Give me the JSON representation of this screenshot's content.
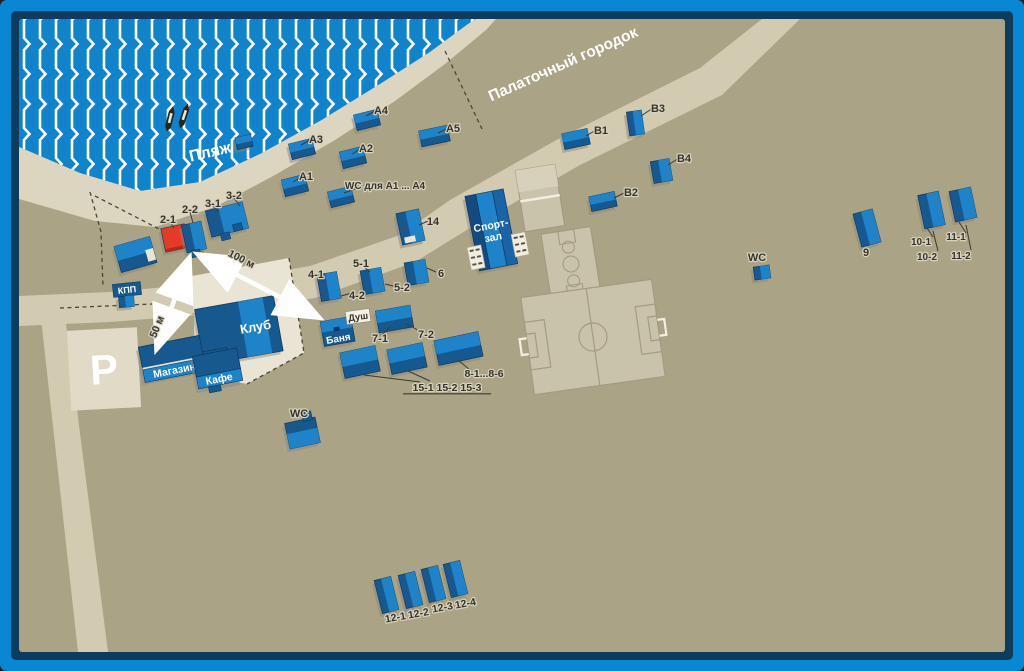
{
  "map_data": {
    "colors": {
      "frame_outer": "#0a87d3",
      "frame_inner": "#0e3c5f",
      "ground": "#aba385",
      "water": "#0f83cb",
      "wave": "#ffffff",
      "sand": "#dcd5c0",
      "road": "#d2cbb2",
      "plaza": "#e9e4d3",
      "parking": "#e0dac7",
      "field": "#c9c3ac",
      "field_line": "#a09880",
      "bldg_dark": "#17598f",
      "bldg_bright": "#1f83c9",
      "bldg_edge": "#0b3b64",
      "red_bright": "#e63a28",
      "red_dark": "#b52718",
      "shadow": "#8e8671",
      "white_detail": "#e9e4d4",
      "label": "#35332c"
    },
    "area_labels": {
      "beach": "Пляж",
      "tent_city": "Палаточный городок",
      "parking": "P",
      "sport_hall_1": "Спорт-",
      "sport_hall_2": "зал",
      "club": "Клуб",
      "shop": "Магазин",
      "cafe": "Кафе",
      "banya": "Баня",
      "dush": "Душ",
      "kpp": "КПП"
    },
    "arrows": [
      {
        "id": "arrow-50m",
        "text": "50 м",
        "x1": 157,
        "y1": 348,
        "x2": 189,
        "y2": 259,
        "tx": 160,
        "ty": 328,
        "rot": -68
      },
      {
        "id": "arrow-100m",
        "text": "100 м",
        "x1": 199,
        "y1": 255,
        "x2": 318,
        "y2": 317,
        "tx": 240,
        "ty": 262,
        "rot": 27
      }
    ],
    "buildings": [
      {
        "id": "A1",
        "x": 283,
        "y": 177,
        "w": 24,
        "h": 17,
        "a": -14,
        "s": "h"
      },
      {
        "id": "A2",
        "x": 341,
        "y": 149,
        "w": 24,
        "h": 17,
        "a": -14,
        "s": "h"
      },
      {
        "id": "A3",
        "x": 290,
        "y": 141,
        "w": 24,
        "h": 16,
        "a": -14,
        "s": "h"
      },
      {
        "id": "A4",
        "x": 355,
        "y": 112,
        "w": 24,
        "h": 16,
        "a": -14,
        "s": "h"
      },
      {
        "id": "A5",
        "x": 420,
        "y": 128,
        "w": 29,
        "h": 16,
        "a": -12,
        "s": "h"
      },
      {
        "id": "wc-a",
        "x": 329,
        "y": 189,
        "w": 24,
        "h": 16,
        "a": -14,
        "s": "h"
      },
      {
        "id": "B1",
        "x": 563,
        "y": 131,
        "w": 26,
        "h": 16,
        "a": -12,
        "s": "h"
      },
      {
        "id": "B2",
        "x": 590,
        "y": 194,
        "w": 26,
        "h": 15,
        "a": -12,
        "s": "h"
      },
      {
        "id": "B3",
        "x": 628,
        "y": 111,
        "w": 15,
        "h": 24,
        "a": -8,
        "s": "v"
      },
      {
        "id": "B4",
        "x": 652,
        "y": 160,
        "w": 19,
        "h": 22,
        "a": -10,
        "s": "v"
      },
      {
        "id": "9",
        "x": 857,
        "y": 211,
        "w": 20,
        "h": 34,
        "a": -15,
        "s": "v"
      },
      {
        "id": "10",
        "x": 921,
        "y": 193,
        "w": 21,
        "h": 34,
        "a": -12,
        "s": "v"
      },
      {
        "id": "11",
        "x": 952,
        "y": 189,
        "w": 22,
        "h": 31,
        "a": -12,
        "s": "v"
      },
      {
        "id": "14",
        "x": 399,
        "y": 211,
        "w": 23,
        "h": 32,
        "a": -12,
        "s": "v",
        "wx": [
          [
            402,
            236,
            11,
            6
          ]
        ]
      },
      {
        "id": "12-1",
        "x": 378,
        "y": 578,
        "w": 17,
        "h": 34,
        "a": -14,
        "s": "v"
      },
      {
        "id": "12-2",
        "x": 402,
        "y": 573,
        "w": 17,
        "h": 34,
        "a": -14,
        "s": "v"
      },
      {
        "id": "12-3",
        "x": 425,
        "y": 567,
        "w": 17,
        "h": 34,
        "a": -14,
        "s": "v"
      },
      {
        "id": "12-4",
        "x": 447,
        "y": 562,
        "w": 17,
        "h": 34,
        "a": -14,
        "s": "v"
      },
      {
        "id": "4",
        "x": 319,
        "y": 273,
        "w": 20,
        "h": 27,
        "a": -10,
        "s": "v"
      },
      {
        "id": "5",
        "x": 362,
        "y": 269,
        "w": 21,
        "h": 24,
        "a": -10,
        "s": "v"
      },
      {
        "id": "6",
        "x": 406,
        "y": 261,
        "w": 21,
        "h": 23,
        "a": -10,
        "s": "v"
      },
      {
        "id": "2-1",
        "x": 163,
        "y": 226,
        "w": 24,
        "h": 24,
        "a": -12,
        "s": "red"
      },
      {
        "id": "2-2",
        "x": 184,
        "y": 223,
        "w": 20,
        "h": 28,
        "a": -12,
        "s": "v",
        "ax": [
          [
            188,
            250,
            9,
            7
          ]
        ]
      },
      {
        "id": "3",
        "x": 208,
        "y": 206,
        "w": 38,
        "h": 27,
        "a": -14,
        "s": "v3",
        "ax": [
          [
            217,
            232,
            9,
            7
          ],
          [
            231,
            226,
            9,
            7
          ]
        ]
      },
      {
        "id": "gate",
        "x": 117,
        "y": 241,
        "w": 37,
        "h": 27,
        "a": -16,
        "s": "h",
        "wx": [
          [
            146,
            253,
            8,
            12
          ]
        ]
      },
      {
        "id": "7",
        "x": 377,
        "y": 308,
        "w": 35,
        "h": 22,
        "a": -10,
        "s": "h"
      },
      {
        "id": "15-1",
        "x": 342,
        "y": 349,
        "w": 36,
        "h": 26,
        "a": -12,
        "s": "h"
      },
      {
        "id": "15-2",
        "x": 389,
        "y": 346,
        "w": 36,
        "h": 25,
        "a": -12,
        "s": "h"
      },
      {
        "id": "8",
        "x": 436,
        "y": 336,
        "w": 45,
        "h": 25,
        "a": -12,
        "s": "h"
      },
      {
        "id": "wc-right",
        "x": 754,
        "y": 266,
        "w": 16,
        "h": 13,
        "a": -8,
        "s": "v"
      },
      {
        "id": "wc-bottom",
        "x": 287,
        "y": 420,
        "w": 31,
        "h": 26,
        "a": -12,
        "s": "h2",
        "ax": [
          [
            306,
            413,
            9,
            9
          ]
        ]
      },
      {
        "id": "beach-hut",
        "x": 236,
        "y": 136,
        "w": 16,
        "h": 12,
        "a": -12,
        "s": "h"
      },
      {
        "id": "kpp-post",
        "x": 119,
        "y": 296,
        "w": 15,
        "h": 11,
        "a": -5,
        "s": "v"
      }
    ],
    "labels": [
      {
        "t": "A1",
        "x": 306,
        "y": 176
      },
      {
        "t": "A2",
        "x": 366,
        "y": 148
      },
      {
        "t": "A3",
        "x": 316,
        "y": 139
      },
      {
        "t": "A4",
        "x": 381,
        "y": 110
      },
      {
        "t": "A5",
        "x": 453,
        "y": 128
      },
      {
        "t": "WC для А1 ... А4",
        "x": 385,
        "y": 185,
        "fs": 10
      },
      {
        "t": "14",
        "x": 433,
        "y": 221
      },
      {
        "t": "B1",
        "x": 601,
        "y": 130
      },
      {
        "t": "B2",
        "x": 631,
        "y": 192
      },
      {
        "t": "B3",
        "x": 658,
        "y": 108
      },
      {
        "t": "B4",
        "x": 684,
        "y": 158
      },
      {
        "t": "9",
        "x": 866,
        "y": 252
      },
      {
        "t": "10-1",
        "x": 921,
        "y": 241,
        "fs": 10
      },
      {
        "t": "10-2",
        "x": 927,
        "y": 256,
        "fs": 10
      },
      {
        "t": "11-1",
        "x": 956,
        "y": 236,
        "fs": 10
      },
      {
        "t": "11-2",
        "x": 961,
        "y": 255,
        "fs": 10
      },
      {
        "t": "2-1",
        "x": 168,
        "y": 219
      },
      {
        "t": "2-2",
        "x": 190,
        "y": 209
      },
      {
        "t": "3-1",
        "x": 213,
        "y": 203
      },
      {
        "t": "3-2",
        "x": 234,
        "y": 195
      },
      {
        "t": "4-1",
        "x": 316,
        "y": 274
      },
      {
        "t": "4-2",
        "x": 357,
        "y": 295
      },
      {
        "t": "5-1",
        "x": 361,
        "y": 263
      },
      {
        "t": "5-2",
        "x": 402,
        "y": 287
      },
      {
        "t": "6",
        "x": 441,
        "y": 273
      },
      {
        "t": "7-1",
        "x": 380,
        "y": 338
      },
      {
        "t": "7-2",
        "x": 426,
        "y": 334
      },
      {
        "t": "8-1...8-6",
        "x": 484,
        "y": 373,
        "fs": 10.5
      },
      {
        "t": "15-1  15-2  15-3",
        "x": 447,
        "y": 387,
        "fs": 10.5,
        "ul": true
      },
      {
        "t": "12-1",
        "x": 396,
        "y": 617,
        "r": -10,
        "fs": 10.5
      },
      {
        "t": "12-2",
        "x": 419,
        "y": 613,
        "r": -10,
        "fs": 10.5
      },
      {
        "t": "12-3",
        "x": 443,
        "y": 607,
        "r": -10,
        "fs": 10.5
      },
      {
        "t": "12-4",
        "x": 466,
        "y": 603,
        "r": -10,
        "fs": 10.5
      },
      {
        "t": "WC",
        "x": 757,
        "y": 257
      },
      {
        "t": "WC",
        "x": 299,
        "y": 413
      }
    ],
    "leaders": [
      [
        303,
        176,
        293,
        182
      ],
      [
        362,
        148,
        352,
        154
      ],
      [
        312,
        139,
        301,
        145
      ],
      [
        377,
        110,
        366,
        116
      ],
      [
        449,
        128,
        438,
        133
      ],
      [
        360,
        187,
        344,
        193
      ],
      [
        596,
        130,
        586,
        136
      ],
      [
        626,
        192,
        614,
        198
      ],
      [
        653,
        108,
        641,
        116
      ],
      [
        679,
        158,
        668,
        165
      ],
      [
        428,
        221,
        419,
        225
      ],
      [
        169,
        221,
        174,
        228
      ],
      [
        190,
        212,
        193,
        223
      ],
      [
        213,
        206,
        219,
        212
      ],
      [
        234,
        198,
        240,
        206
      ],
      [
        318,
        277,
        324,
        281
      ],
      [
        352,
        293,
        341,
        296
      ],
      [
        363,
        266,
        370,
        272
      ],
      [
        397,
        287,
        385,
        284
      ],
      [
        436,
        272,
        427,
        268
      ],
      [
        382,
        335,
        390,
        327
      ],
      [
        421,
        332,
        407,
        324
      ],
      [
        470,
        370,
        458,
        360
      ],
      [
        430,
        381,
        408,
        371
      ],
      [
        420,
        382,
        364,
        375
      ],
      [
        933,
        237,
        927,
        228
      ],
      [
        938,
        251,
        933,
        231
      ],
      [
        966,
        233,
        959,
        222
      ],
      [
        971,
        250,
        966,
        225
      ]
    ],
    "boundaries": [
      "445,51 482,129",
      "90,192 101,232 103,287",
      "95,196 200,250 232,276",
      "60,308 152,304",
      "289,258 304,353 247,384"
    ]
  }
}
